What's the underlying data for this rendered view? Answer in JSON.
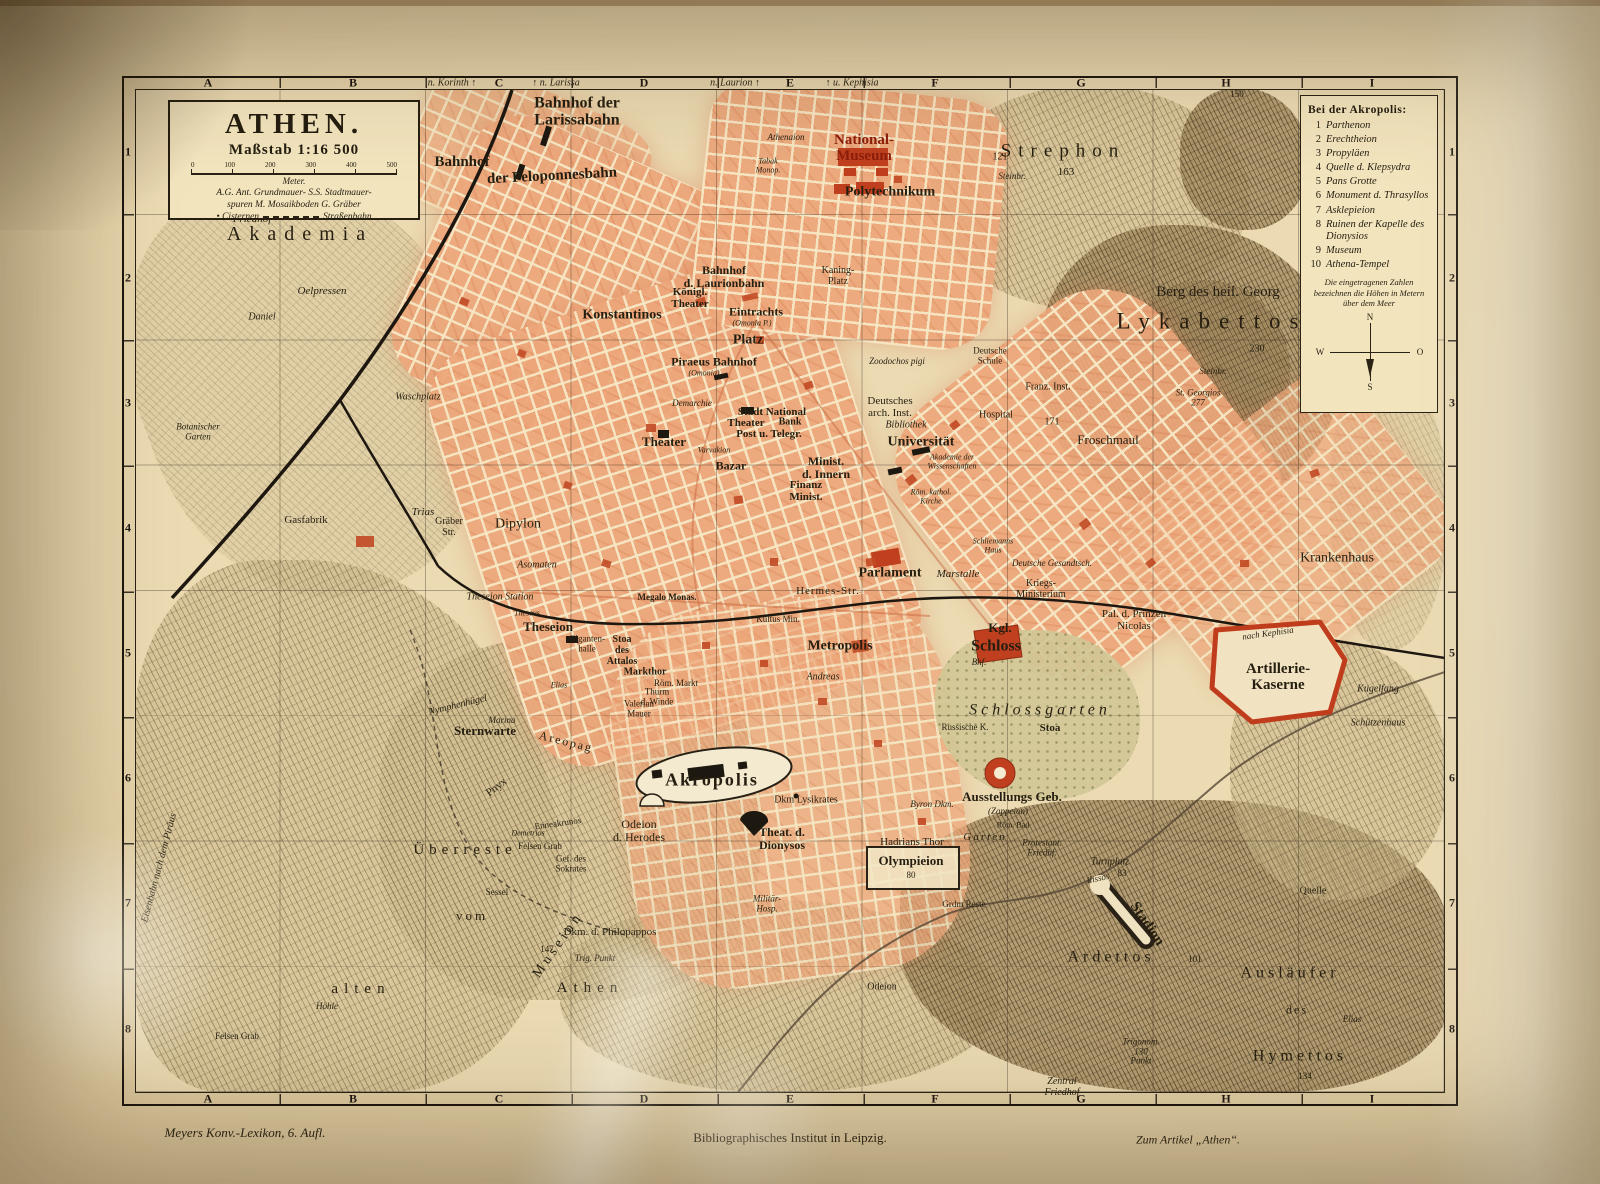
{
  "title_box": {
    "title": "ATHEN.",
    "scale": "Maßstab 1:16 500",
    "ticks": [
      "0",
      "100",
      "200",
      "300",
      "400",
      "500"
    ],
    "meter": "Meter.",
    "legend_line1": "A.G. Ant. Grundmauer- S.S. Stadtmauer-",
    "legend_line2": "spuren   M. Mosaikboden   G. Gräber",
    "legend_cisternen": "• Cisternen",
    "legend_strassenbahn": "Straßenbahn"
  },
  "akropolis_legend": {
    "title": "Bei der Akropolis:",
    "items": [
      {
        "num": "1",
        "label": "Parthenon"
      },
      {
        "num": "2",
        "label": "Erechtheion"
      },
      {
        "num": "3",
        "label": "Propyläen"
      },
      {
        "num": "4",
        "label": "Quelle d. Klepsydra"
      },
      {
        "num": "5",
        "label": "Pans Grotte"
      },
      {
        "num": "6",
        "label": "Monument d. Thrasyllos"
      },
      {
        "num": "7",
        "label": "Asklepieion"
      },
      {
        "num": "8",
        "label": "Ruinen der Kapelle des Dionysios"
      },
      {
        "num": "9",
        "label": "Museum"
      },
      {
        "num": "10",
        "label": "Athena-Tempel"
      }
    ],
    "note": "Die eingetragenen Zahlen bezeichnen die Höhen in Metern über dem Meer",
    "compass": {
      "n": "N",
      "o": "O",
      "s": "S",
      "w": "W"
    }
  },
  "grid": {
    "cols": [
      "A",
      "B",
      "C",
      "D",
      "E",
      "F",
      "G",
      "H",
      "I"
    ],
    "rows": [
      "1",
      "2",
      "3",
      "4",
      "5",
      "6",
      "7",
      "8"
    ]
  },
  "imprint": {
    "left": "Meyers Konv.-Lexikon, 6. Aufl.",
    "center": "Bibliographisches Institut in Leipzig.",
    "right": "Zum Artikel „Athen“."
  },
  "labels": {
    "akademia": "Akademia",
    "friedhof_nw": "Friedhof",
    "oelpressen": "Oelpressen",
    "daniel": "Daniel",
    "strephon": "Strephon",
    "h163": "163",
    "h121": "121",
    "steinbr_n": "Steinbr.",
    "berg_georg": "Berg des heil. Georg",
    "lykabettos": "Lykabettos",
    "h230": "230",
    "steinbr_e": "Steinbr.",
    "st_georgios": "St. Georgios\n277",
    "froschmaul": "Froschmaul",
    "h171": "171",
    "h150": "150",
    "bahnhof_larissa": "Bahnhof der\nLarissabahn",
    "bahnhof_w": "Bahnhof",
    "peloponnesbahn": "der Peloponnesbahn",
    "national_museum": "National-\nMuseum",
    "polytechnikum": "Polytechnikum",
    "konstantinos": "Konstantinos",
    "koenigl_theater": "Königl.\nTheater",
    "bahnhof_laurion": "Bahnhof\nd. Laurionbahn",
    "eintracht": "Eintrachts",
    "omonia_p": "(Omonia P.)",
    "platz": "Platz",
    "piraeus_bahnhof": "Piraeus Bahnhof",
    "omonia": "(Omonia)",
    "kaning_platz": "Kaning-\nPlatz",
    "tabak": "Tabak\nMonop.",
    "athenaion": "Athenaion",
    "demarchie": "Demarchie",
    "stadt_national": "Stadt National",
    "theater_sn": "Theater",
    "bank": "Bank",
    "post": "Post u. Telegr.",
    "theater_w": "Theater",
    "varvakion": "Varvakion",
    "bazar": "Bazar",
    "minist_innern": "Minist.\nd. Innern",
    "finanz": "Finanz\nMinist.",
    "deutsches_inst": "Deutsches\narch. Inst.",
    "bibliothek": "Bibliothek",
    "universitaet": "Universität",
    "hospital": "Hospital",
    "akademie_wiss": "Akademie der\nWissenschaften",
    "zoodochos": "Zoodochos pigi",
    "deutsche_schule": "Deutsche\nSchule",
    "franz_inst": "Franz. Inst.",
    "rom_kath": "Röm. kathol.\nKirche",
    "schliemann": "Schliemanns\nHaus",
    "kultus": "Kultus Min.",
    "andreas": "Andreas",
    "metropolis": "Metropolis",
    "kgl": "Kgl.",
    "schloss": "Schloss",
    "bhf": "Bhf.",
    "parlament": "Parlament",
    "marstalle": "Marstalle",
    "kriegs": "Kriegs-\nMinisterium",
    "gesandtsch": "Deutsche Gesandtsch.",
    "prinzen": "Pal. d. Prinzen\nNicolas",
    "schlossgarten": "Schlossgarten",
    "russische": "Russische K.",
    "stoa": "Stoa",
    "hermes": "Hermes-Str.",
    "megalo": "Megalo Monas.",
    "asomaten": "Asomaten",
    "dipylon": "Dipylon",
    "graeber_str": "Gräber\nStr.",
    "trias": "Trias",
    "gasfabrik": "Gasfabrik",
    "waschplatz": "Waschplatz",
    "botanischer": "Botanischer\nGarten",
    "eisenbahn": "Eisenbahn nach dem Piräus",
    "theseion_station": "Theseion Station",
    "theseus": "Theseus",
    "theseion": "Theseion",
    "giganten": "Giganten-\nhalle",
    "attalos": "Stoa\ndes\nAttalos",
    "markthor": "Markthor",
    "thurm": "Thurm\nd. Winde",
    "rom_markt": "Röm. Markt",
    "valerian": "Valerian\nMauer",
    "elias_w": "Elias",
    "nymphenhuegel": "Nymphenhügel",
    "marina": "Marina",
    "sternwarte": "Sternwarte",
    "areopag": "Areopag",
    "pnyx": "Pnyx",
    "enneakrunos": "Enneakrunos",
    "demetrios": "Demetrios",
    "akropolis": "Akropolis",
    "odeion_herodes": "Odeion\nd. Herodes",
    "theat_dionysos": "Theat. d.\nDionysos",
    "lysikrates": "Dkm Lysikrates",
    "hadrians": "Hadrians Thor",
    "olympieion": "Olympieion",
    "h80": "80",
    "militaer": "Militär-\nHosp.",
    "grdm": "Grdm Reste",
    "ueberreste": "Überreste",
    "vom": "vom",
    "museion": "Museion",
    "alten": "alten",
    "athen_alt": "Athen",
    "philopappos": "Dkm. d. Philopappos",
    "h147": "147",
    "trig_punkt": "Trig. Punkt",
    "felsen_grab": "Felsen Grab",
    "sokrates": "Gef. des\nSokrates",
    "sessel": "Sessel",
    "hoehle": "Höhle",
    "felsen_grab2": "Felsen Grab",
    "ausstellung": "Ausstellungs Geb.",
    "zappeion": "(Zappeion)",
    "rom_bad": "Röm. Bad",
    "byron": "Byron Dkm.",
    "garten": "Garten",
    "protestant": "Protestant.\nFriedhf.",
    "turnplatz": "Turnplatz",
    "h83": "83",
    "ilissos": "Ilissos",
    "stadion": "Stadion",
    "ardettos": "Ardettos",
    "h101": "101",
    "auslaeufer": "Ausläufer",
    "des": "des",
    "hymettos": "Hymettos",
    "h134": "134",
    "elias_s": "Elias",
    "quelle": "Quelle",
    "trigonom": "Trigonom.\n130\nPunkt",
    "zentral_friedhof": "Zentral\nFriedhof",
    "odeion_s": "Odeion",
    "krankenhaus": "Krankenhaus",
    "artillerie": "Artillerie-\nKaserne",
    "kugelfang": "Kugelfang",
    "schuetzenhaus": "Schützenhaus",
    "nach_kephisia": "nach Kephisia",
    "n_korinth": "n. Korinth ↑",
    "n_larissa": "↑ n. Larissa",
    "n_laurion": "n. Laurion ↑",
    "u_kephisia": "↑ u. Kephisia"
  }
}
